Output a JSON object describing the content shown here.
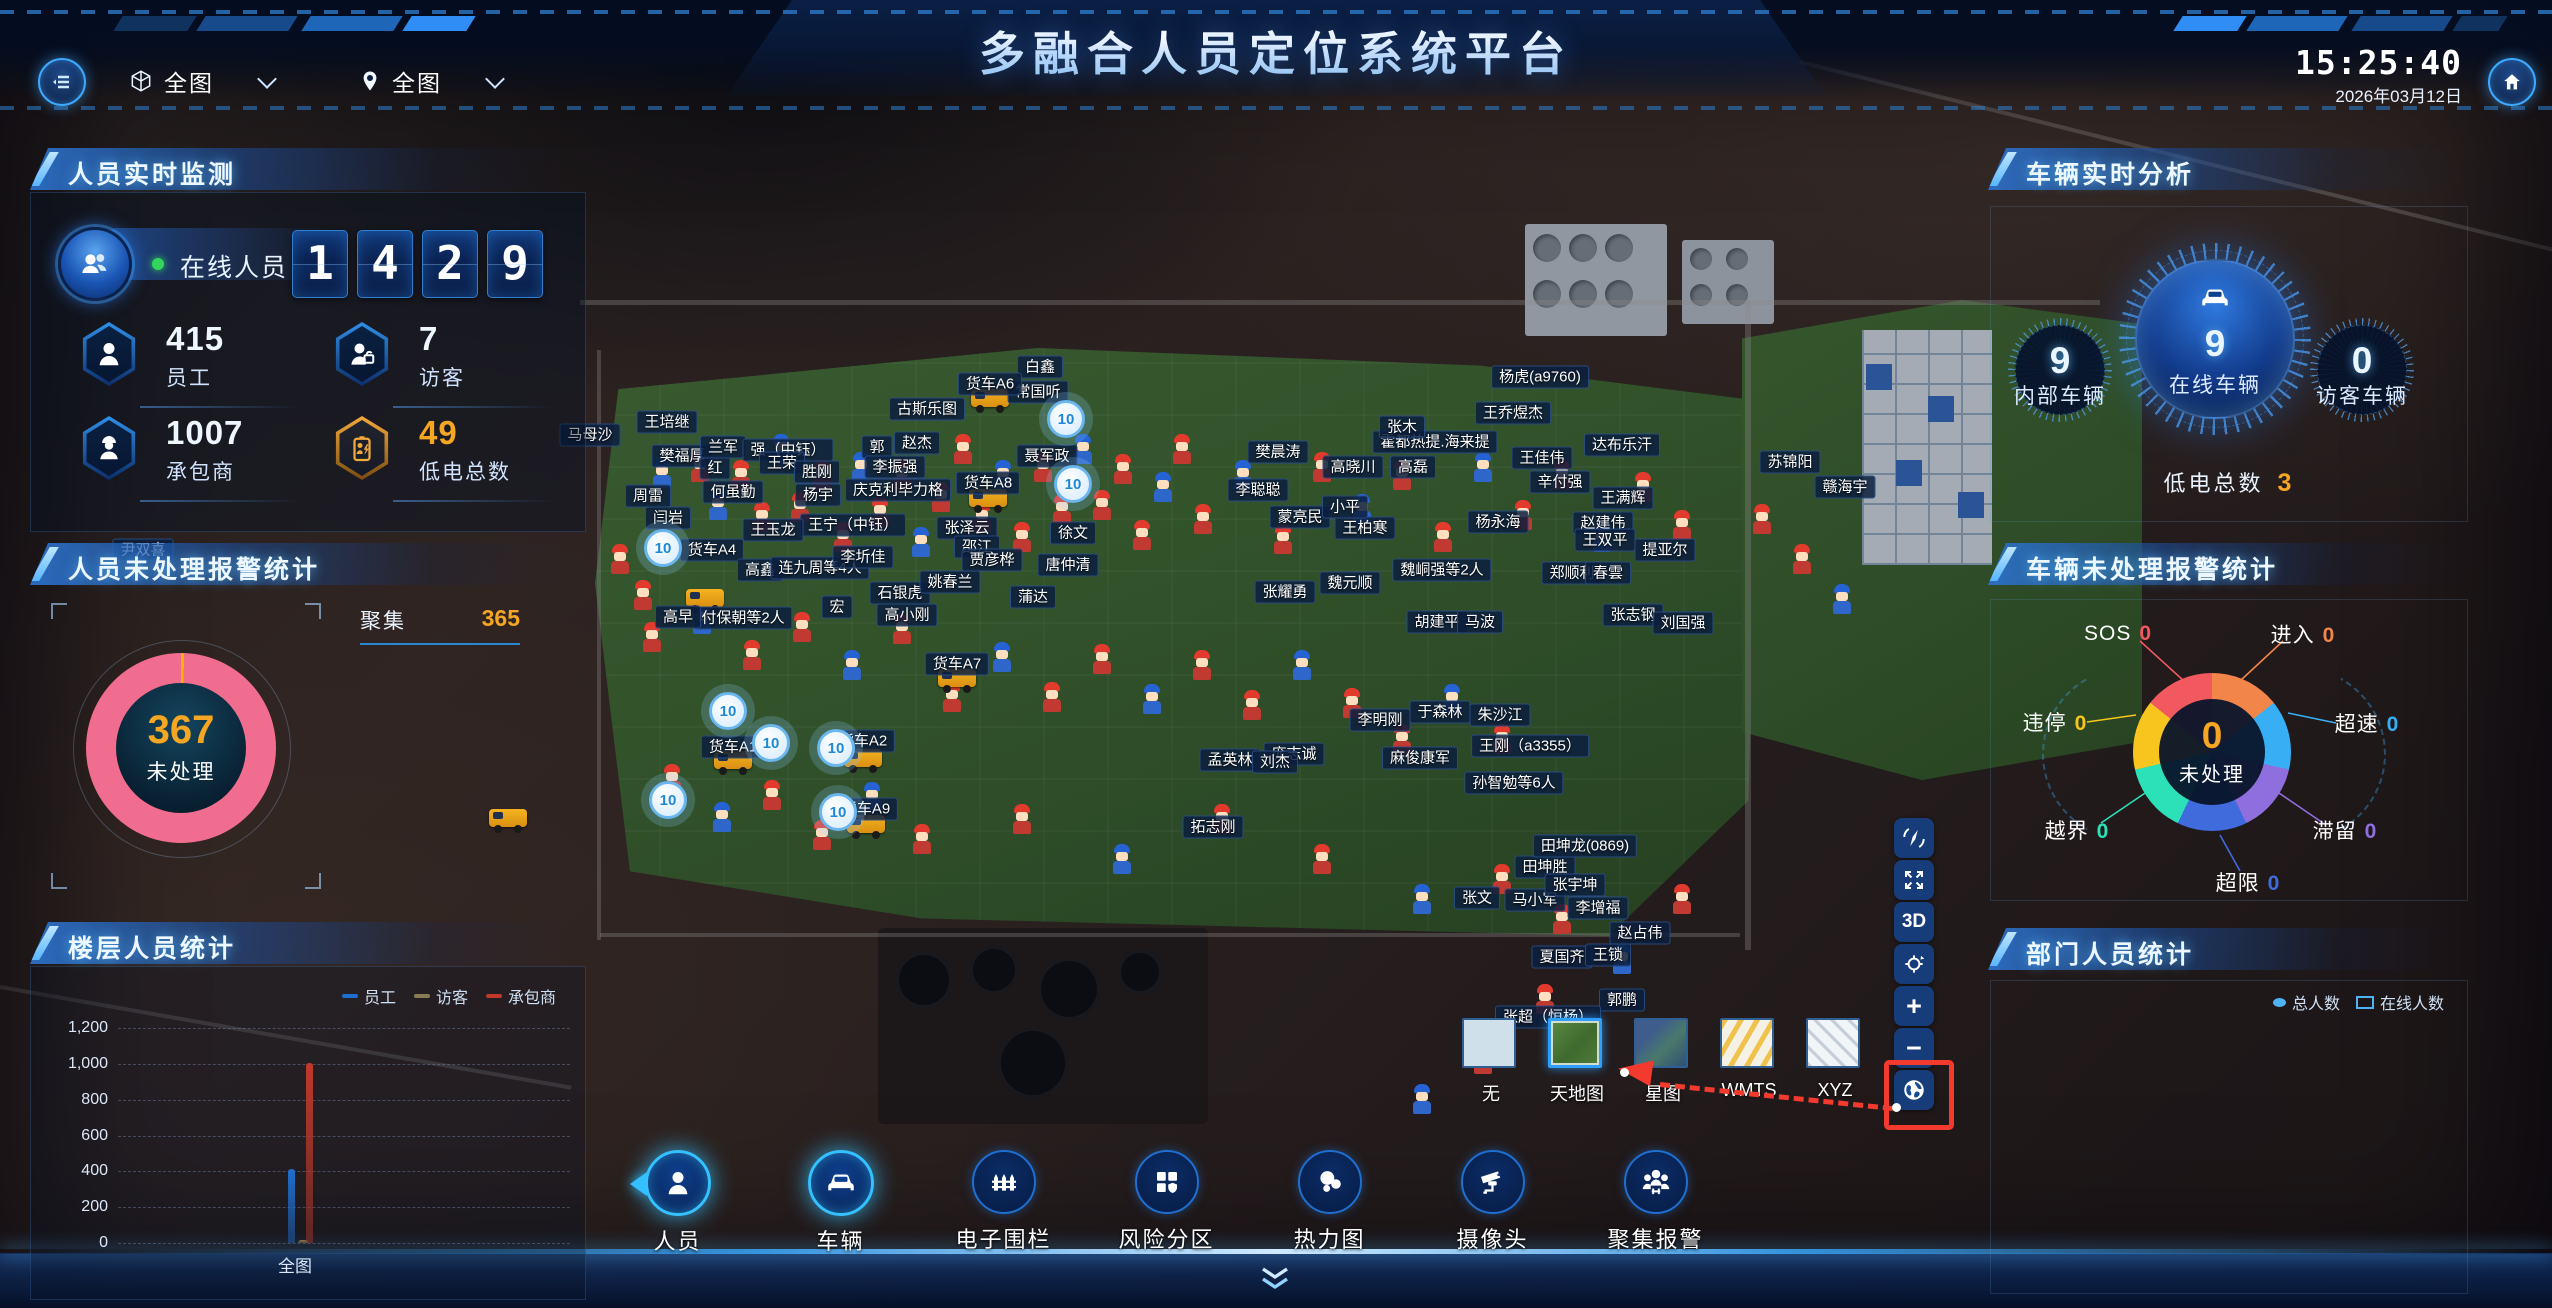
{
  "header": {
    "title": "多融合人员定位系统平台",
    "time": "15:25:40",
    "date": "2026年03月12日",
    "map_select_label": "全图",
    "area_select_label": "全图"
  },
  "personnel_panel": {
    "title": "人员实时监测",
    "online_label": "在线人员",
    "online_digits": [
      "1",
      "4",
      "2",
      "9"
    ],
    "stats": [
      {
        "value": "415",
        "label": "员工",
        "icon": "person",
        "accent": "#eef7ff"
      },
      {
        "value": "7",
        "label": "访客",
        "icon": "visitor",
        "accent": "#eef7ff"
      },
      {
        "value": "1007",
        "label": "承包商",
        "icon": "contractor",
        "accent": "#eef7ff"
      },
      {
        "value": "49",
        "label": "低电总数",
        "icon": "battery",
        "accent": "#f5a623"
      }
    ]
  },
  "personnel_alarm_panel": {
    "title": "人员未处理报警统计",
    "center_value": "367",
    "center_label": "未处理",
    "legend": [
      {
        "label": "聚集",
        "value": "365"
      }
    ],
    "chart_data": {
      "type": "pie",
      "title": "人员未处理报警统计",
      "total": 367,
      "slices": [
        {
          "label": "聚集",
          "value": 365,
          "color": "#f16d8f"
        },
        {
          "label": "其他",
          "value": 2,
          "color": "#ffb400"
        }
      ]
    }
  },
  "floor_panel": {
    "title": "楼层人员统计",
    "category_label": "全图",
    "chart_data": {
      "type": "bar",
      "categories": [
        "全图"
      ],
      "series": [
        {
          "name": "员工",
          "values": [
            415
          ],
          "color": "#1f6fd0"
        },
        {
          "name": "访客",
          "values": [
            7
          ],
          "color": "#8a7a55"
        },
        {
          "name": "承包商",
          "values": [
            1007
          ],
          "color": "#c0392b"
        }
      ],
      "ylim": [
        0,
        1200
      ],
      "yticks": [
        "1,200",
        "1,000",
        "800",
        "600",
        "400",
        "200",
        "0"
      ],
      "grid": "dashed"
    }
  },
  "vehicle_panel": {
    "title": "车辆实时分析",
    "gauges": [
      {
        "value": "9",
        "label": "内部车辆"
      },
      {
        "value": "9",
        "label": "在线车辆"
      },
      {
        "value": "0",
        "label": "访客车辆"
      }
    ],
    "low_battery_label": "低电总数",
    "low_battery_value": "3"
  },
  "vehicle_alarm_panel": {
    "title": "车辆未处理报警统计",
    "center_value": "0",
    "center_label": "未处理",
    "chart_data": {
      "type": "pie",
      "title": "车辆未处理报警统计",
      "slices": [
        {
          "label": "进入",
          "value": 0,
          "color": "#f2854a",
          "lx": 315,
          "ly": 91,
          "line": [
            295,
            98,
            252,
            138
          ]
        },
        {
          "label": "超速",
          "value": 0,
          "color": "#38aef5",
          "lx": 379,
          "ly": 180,
          "line": [
            348,
            180,
            300,
            170
          ]
        },
        {
          "label": "滞留",
          "value": 0,
          "color": "#8f6ede",
          "lx": 357,
          "ly": 287,
          "line": [
            335,
            280,
            288,
            248
          ]
        },
        {
          "label": "超限",
          "value": 0,
          "color": "#3f6bdd",
          "lx": 260,
          "ly": 339,
          "line": [
            252,
            328,
            232,
            292
          ]
        },
        {
          "label": "越界",
          "value": 0,
          "color": "#2ce0b8",
          "lx": 89,
          "ly": 287,
          "line": [
            113,
            280,
            163,
            246
          ]
        },
        {
          "label": "违停",
          "value": 0,
          "color": "#f7c51e",
          "lx": 67,
          "ly": 179,
          "line": [
            99,
            179,
            148,
            172
          ]
        },
        {
          "label": "SOS",
          "value": 0,
          "color": "#f2595f",
          "lx": 130,
          "ly": 91,
          "line": [
            152,
            98,
            196,
            138
          ]
        }
      ]
    }
  },
  "department_panel": {
    "title": "部门人员统计",
    "legend": [
      "总人数",
      "在线人数"
    ]
  },
  "toolbar": {
    "items": [
      {
        "label": "人员",
        "icon": "person",
        "active": true
      },
      {
        "label": "车辆",
        "icon": "car",
        "active": true
      },
      {
        "label": "电子围栏",
        "icon": "fence",
        "active": false
      },
      {
        "label": "风险分区",
        "icon": "zone",
        "active": false
      },
      {
        "label": "热力图",
        "icon": "heat",
        "active": false
      },
      {
        "label": "摄像头",
        "icon": "camera",
        "active": false
      },
      {
        "label": "聚集报警",
        "icon": "crowd",
        "active": false
      }
    ]
  },
  "layer_selector": {
    "options": [
      {
        "label": "无",
        "key": "none",
        "selected": false
      },
      {
        "label": "天地图",
        "key": "tianditu",
        "selected": true
      },
      {
        "label": "星图",
        "key": "xingtu",
        "selected": false
      },
      {
        "label": "WMTS",
        "key": "wmts",
        "selected": false
      },
      {
        "label": "XYZ",
        "key": "xyz",
        "selected": false
      }
    ]
  },
  "map_controls": [
    {
      "key": "compass"
    },
    {
      "key": "fullscreen"
    },
    {
      "key": "threeD",
      "label": "3D"
    },
    {
      "key": "locate"
    },
    {
      "key": "zoom-in",
      "label": "+"
    },
    {
      "key": "zoom-out",
      "label": "−"
    },
    {
      "key": "globe"
    }
  ],
  "map": {
    "labels": [
      {
        "t": "马母沙",
        "x": 590,
        "y": 435
      },
      {
        "t": "王培继",
        "x": 667,
        "y": 422
      },
      {
        "t": "樊福厚",
        "x": 682,
        "y": 456
      },
      {
        "t": "红",
        "x": 715,
        "y": 468
      },
      {
        "t": "兰军",
        "x": 723,
        "y": 447
      },
      {
        "t": "强（中钰）",
        "x": 788,
        "y": 450
      },
      {
        "t": "王荣",
        "x": 782,
        "y": 463
      },
      {
        "t": "胜刚",
        "x": 817,
        "y": 472
      },
      {
        "t": "何虽勤",
        "x": 733,
        "y": 492
      },
      {
        "t": "杨宇",
        "x": 818,
        "y": 495
      },
      {
        "t": "庆克利毕力格",
        "x": 898,
        "y": 490
      },
      {
        "t": "古斯乐图",
        "x": 927,
        "y": 409
      },
      {
        "t": "赵杰",
        "x": 917,
        "y": 443
      },
      {
        "t": "郭",
        "x": 877,
        "y": 447
      },
      {
        "t": "李振强",
        "x": 895,
        "y": 467
      },
      {
        "t": "白鑫",
        "x": 1040,
        "y": 367
      },
      {
        "t": "常国听",
        "x": 1038,
        "y": 392
      },
      {
        "t": "聂军政",
        "x": 1047,
        "y": 456
      },
      {
        "t": "杨虎(a9760)",
        "x": 1540,
        "y": 377
      },
      {
        "t": "王乔煜杰",
        "x": 1513,
        "y": 413
      },
      {
        "t": "霍都热提.海来提",
        "x": 1435,
        "y": 442
      },
      {
        "t": "达布乐汗",
        "x": 1622,
        "y": 445
      },
      {
        "t": "王佳伟",
        "x": 1542,
        "y": 458
      },
      {
        "t": "辛付强",
        "x": 1560,
        "y": 482
      },
      {
        "t": "王满辉",
        "x": 1623,
        "y": 498
      },
      {
        "t": "苏锦阳",
        "x": 1790,
        "y": 462
      },
      {
        "t": "赣海宇",
        "x": 1845,
        "y": 487
      },
      {
        "t": "樊晨涛",
        "x": 1278,
        "y": 452
      },
      {
        "t": "李聪聪",
        "x": 1258,
        "y": 490
      },
      {
        "t": "蒙亮民",
        "x": 1300,
        "y": 517
      },
      {
        "t": "王柏寒",
        "x": 1365,
        "y": 528
      },
      {
        "t": "杨永海",
        "x": 1498,
        "y": 522
      },
      {
        "t": "赵建伟",
        "x": 1603,
        "y": 523
      },
      {
        "t": "王双平",
        "x": 1605,
        "y": 540
      },
      {
        "t": "提亚尔",
        "x": 1665,
        "y": 550
      },
      {
        "t": "张木",
        "x": 1402,
        "y": 427
      },
      {
        "t": "高晓川",
        "x": 1353,
        "y": 467
      },
      {
        "t": "高磊",
        "x": 1413,
        "y": 467
      },
      {
        "t": "小平",
        "x": 1345,
        "y": 507
      },
      {
        "t": "张泽云",
        "x": 967,
        "y": 528
      },
      {
        "t": "王宁（中钰）",
        "x": 853,
        "y": 525
      },
      {
        "t": "王玉龙",
        "x": 773,
        "y": 530
      },
      {
        "t": "货车A4",
        "x": 712,
        "y": 550
      },
      {
        "t": "货车A6",
        "x": 990,
        "y": 384
      },
      {
        "t": "货车A8",
        "x": 988,
        "y": 483
      },
      {
        "t": "货车A7",
        "x": 957,
        "y": 664
      },
      {
        "t": "货车A2",
        "x": 863,
        "y": 741
      },
      {
        "t": "货车A1",
        "x": 733,
        "y": 747
      },
      {
        "t": "货车A9",
        "x": 866,
        "y": 809
      },
      {
        "t": "高鑫",
        "x": 760,
        "y": 570
      },
      {
        "t": "连九周等4人",
        "x": 820,
        "y": 568
      },
      {
        "t": "李圻佳",
        "x": 863,
        "y": 557
      },
      {
        "t": "石银虎",
        "x": 900,
        "y": 593
      },
      {
        "t": "高小刚",
        "x": 907,
        "y": 615
      },
      {
        "t": "姚春兰",
        "x": 950,
        "y": 582
      },
      {
        "t": "邵江",
        "x": 977,
        "y": 547
      },
      {
        "t": "贾彦桦",
        "x": 992,
        "y": 560
      },
      {
        "t": "唐仲清",
        "x": 1068,
        "y": 565
      },
      {
        "t": "蒲达",
        "x": 1033,
        "y": 597
      },
      {
        "t": "付保朝等2人",
        "x": 743,
        "y": 618
      },
      {
        "t": "高早",
        "x": 678,
        "y": 617
      },
      {
        "t": "宏",
        "x": 837,
        "y": 607
      },
      {
        "t": "徐文",
        "x": 1073,
        "y": 533
      },
      {
        "t": "周雷",
        "x": 648,
        "y": 496
      },
      {
        "t": "闫岩",
        "x": 668,
        "y": 518
      },
      {
        "t": "尹双喜",
        "x": 143,
        "y": 550
      },
      {
        "t": "魏峒强等2人",
        "x": 1442,
        "y": 570
      },
      {
        "t": "郑顺利",
        "x": 1572,
        "y": 573
      },
      {
        "t": "春雲",
        "x": 1608,
        "y": 573
      },
      {
        "t": "魏元顺",
        "x": 1350,
        "y": 583
      },
      {
        "t": "张耀勇",
        "x": 1285,
        "y": 592
      },
      {
        "t": "胡建平",
        "x": 1437,
        "y": 622
      },
      {
        "t": "马波",
        "x": 1480,
        "y": 622
      },
      {
        "t": "张志钢",
        "x": 1633,
        "y": 615
      },
      {
        "t": "刘国强",
        "x": 1683,
        "y": 623
      },
      {
        "t": "拓志刚",
        "x": 1213,
        "y": 827
      },
      {
        "t": "庞志诚",
        "x": 1294,
        "y": 754
      },
      {
        "t": "孙智勉等6人",
        "x": 1514,
        "y": 783
      },
      {
        "t": "王刚（a3355）",
        "x": 1530,
        "y": 746
      },
      {
        "t": "麻俊康军",
        "x": 1420,
        "y": 758
      },
      {
        "t": "李明刚",
        "x": 1380,
        "y": 720
      },
      {
        "t": "于森林",
        "x": 1440,
        "y": 712
      },
      {
        "t": "朱沙江",
        "x": 1500,
        "y": 715
      },
      {
        "t": "孟英林",
        "x": 1230,
        "y": 760
      },
      {
        "t": "刘杰",
        "x": 1275,
        "y": 762
      },
      {
        "t": "田坤胜",
        "x": 1545,
        "y": 867
      },
      {
        "t": "田坤龙(0869)",
        "x": 1585,
        "y": 846
      },
      {
        "t": "李增福",
        "x": 1598,
        "y": 908
      },
      {
        "t": "张文",
        "x": 1477,
        "y": 898
      },
      {
        "t": "马小军",
        "x": 1535,
        "y": 900
      },
      {
        "t": "张宇坤",
        "x": 1575,
        "y": 885
      },
      {
        "t": "赵占伟",
        "x": 1640,
        "y": 933
      },
      {
        "t": "夏国齐",
        "x": 1562,
        "y": 957
      },
      {
        "t": "王锁",
        "x": 1608,
        "y": 955
      },
      {
        "t": "郭鹏",
        "x": 1622,
        "y": 1000
      },
      {
        "t": "张超（恒杨）",
        "x": 1548,
        "y": 1017
      }
    ],
    "clusters": [
      {
        "v": "10",
        "x": 663,
        "y": 548
      },
      {
        "v": "10",
        "x": 1066,
        "y": 419
      },
      {
        "v": "10",
        "x": 1073,
        "y": 484
      },
      {
        "v": "10",
        "x": 728,
        "y": 711
      },
      {
        "v": "10",
        "x": 771,
        "y": 743
      },
      {
        "v": "10",
        "x": 836,
        "y": 748
      },
      {
        "v": "10",
        "x": 668,
        "y": 800
      },
      {
        "v": "10",
        "x": 838,
        "y": 812
      }
    ],
    "workers": [
      [
        620,
        562,
        "r"
      ],
      [
        643,
        598,
        "r"
      ],
      [
        662,
        476,
        "b"
      ],
      [
        700,
        470,
        "r"
      ],
      [
        718,
        508,
        "b"
      ],
      [
        741,
        478,
        "r"
      ],
      [
        762,
        520,
        "r"
      ],
      [
        781,
        452,
        "b"
      ],
      [
        800,
        510,
        "r"
      ],
      [
        822,
        478,
        "r"
      ],
      [
        843,
        540,
        "r"
      ],
      [
        861,
        470,
        "b"
      ],
      [
        880,
        515,
        "r"
      ],
      [
        902,
        478,
        "r"
      ],
      [
        921,
        545,
        "b"
      ],
      [
        941,
        500,
        "r"
      ],
      [
        963,
        452,
        "r"
      ],
      [
        982,
        520,
        "r"
      ],
      [
        1003,
        478,
        "b"
      ],
      [
        1022,
        540,
        "r"
      ],
      [
        1043,
        470,
        "r"
      ],
      [
        1062,
        512,
        "r"
      ],
      [
        1083,
        452,
        "b"
      ],
      [
        1102,
        508,
        "r"
      ],
      [
        1123,
        472,
        "r"
      ],
      [
        1142,
        538,
        "r"
      ],
      [
        1163,
        490,
        "b"
      ],
      [
        1182,
        452,
        "r"
      ],
      [
        1203,
        522,
        "r"
      ],
      [
        1243,
        478,
        "b"
      ],
      [
        1283,
        542,
        "r"
      ],
      [
        1322,
        470,
        "r"
      ],
      [
        1362,
        512,
        "b"
      ],
      [
        1402,
        478,
        "r"
      ],
      [
        1443,
        540,
        "r"
      ],
      [
        1483,
        470,
        "b"
      ],
      [
        1523,
        518,
        "r"
      ],
      [
        1562,
        478,
        "r"
      ],
      [
        1602,
        540,
        "b"
      ],
      [
        1643,
        490,
        "r"
      ],
      [
        1682,
        528,
        "r"
      ],
      [
        652,
        640,
        "r"
      ],
      [
        702,
        622,
        "b"
      ],
      [
        752,
        658,
        "r"
      ],
      [
        802,
        630,
        "r"
      ],
      [
        852,
        668,
        "b"
      ],
      [
        902,
        632,
        "r"
      ],
      [
        952,
        700,
        "r"
      ],
      [
        1002,
        660,
        "b"
      ],
      [
        1052,
        700,
        "r"
      ],
      [
        1102,
        662,
        "r"
      ],
      [
        1152,
        702,
        "b"
      ],
      [
        1202,
        668,
        "r"
      ],
      [
        1252,
        708,
        "r"
      ],
      [
        1302,
        668,
        "b"
      ],
      [
        1352,
        706,
        "r"
      ],
      [
        1402,
        742,
        "r"
      ],
      [
        1452,
        702,
        "b"
      ],
      [
        1502,
        742,
        "r"
      ],
      [
        672,
        782,
        "r"
      ],
      [
        722,
        820,
        "b"
      ],
      [
        772,
        798,
        "r"
      ],
      [
        822,
        838,
        "r"
      ],
      [
        872,
        800,
        "b"
      ],
      [
        922,
        842,
        "r"
      ],
      [
        1022,
        822,
        "r"
      ],
      [
        1122,
        862,
        "b"
      ],
      [
        1222,
        822,
        "r"
      ],
      [
        1322,
        862,
        "r"
      ],
      [
        1422,
        902,
        "b"
      ],
      [
        1502,
        882,
        "r"
      ],
      [
        1562,
        922,
        "r"
      ],
      [
        1622,
        962,
        "b"
      ],
      [
        1682,
        902,
        "r"
      ],
      [
        1762,
        522,
        "r"
      ],
      [
        1802,
        562,
        "r"
      ],
      [
        1842,
        602,
        "b"
      ],
      [
        1545,
        1002,
        "r"
      ],
      [
        1585,
        1042,
        "b"
      ],
      [
        1483,
        1062,
        "r"
      ],
      [
        1422,
        1102,
        "b"
      ]
    ],
    "trucks": [
      [
        705,
        600
      ],
      [
        990,
        400
      ],
      [
        988,
        500
      ],
      [
        957,
        680
      ],
      [
        863,
        760
      ],
      [
        733,
        762
      ],
      [
        866,
        826
      ],
      [
        508,
        820
      ]
    ]
  },
  "colors": {
    "accent": "#35c0ff",
    "orange": "#f5a623",
    "pink": "#f16d8f",
    "green_dot": "#35d45c"
  }
}
